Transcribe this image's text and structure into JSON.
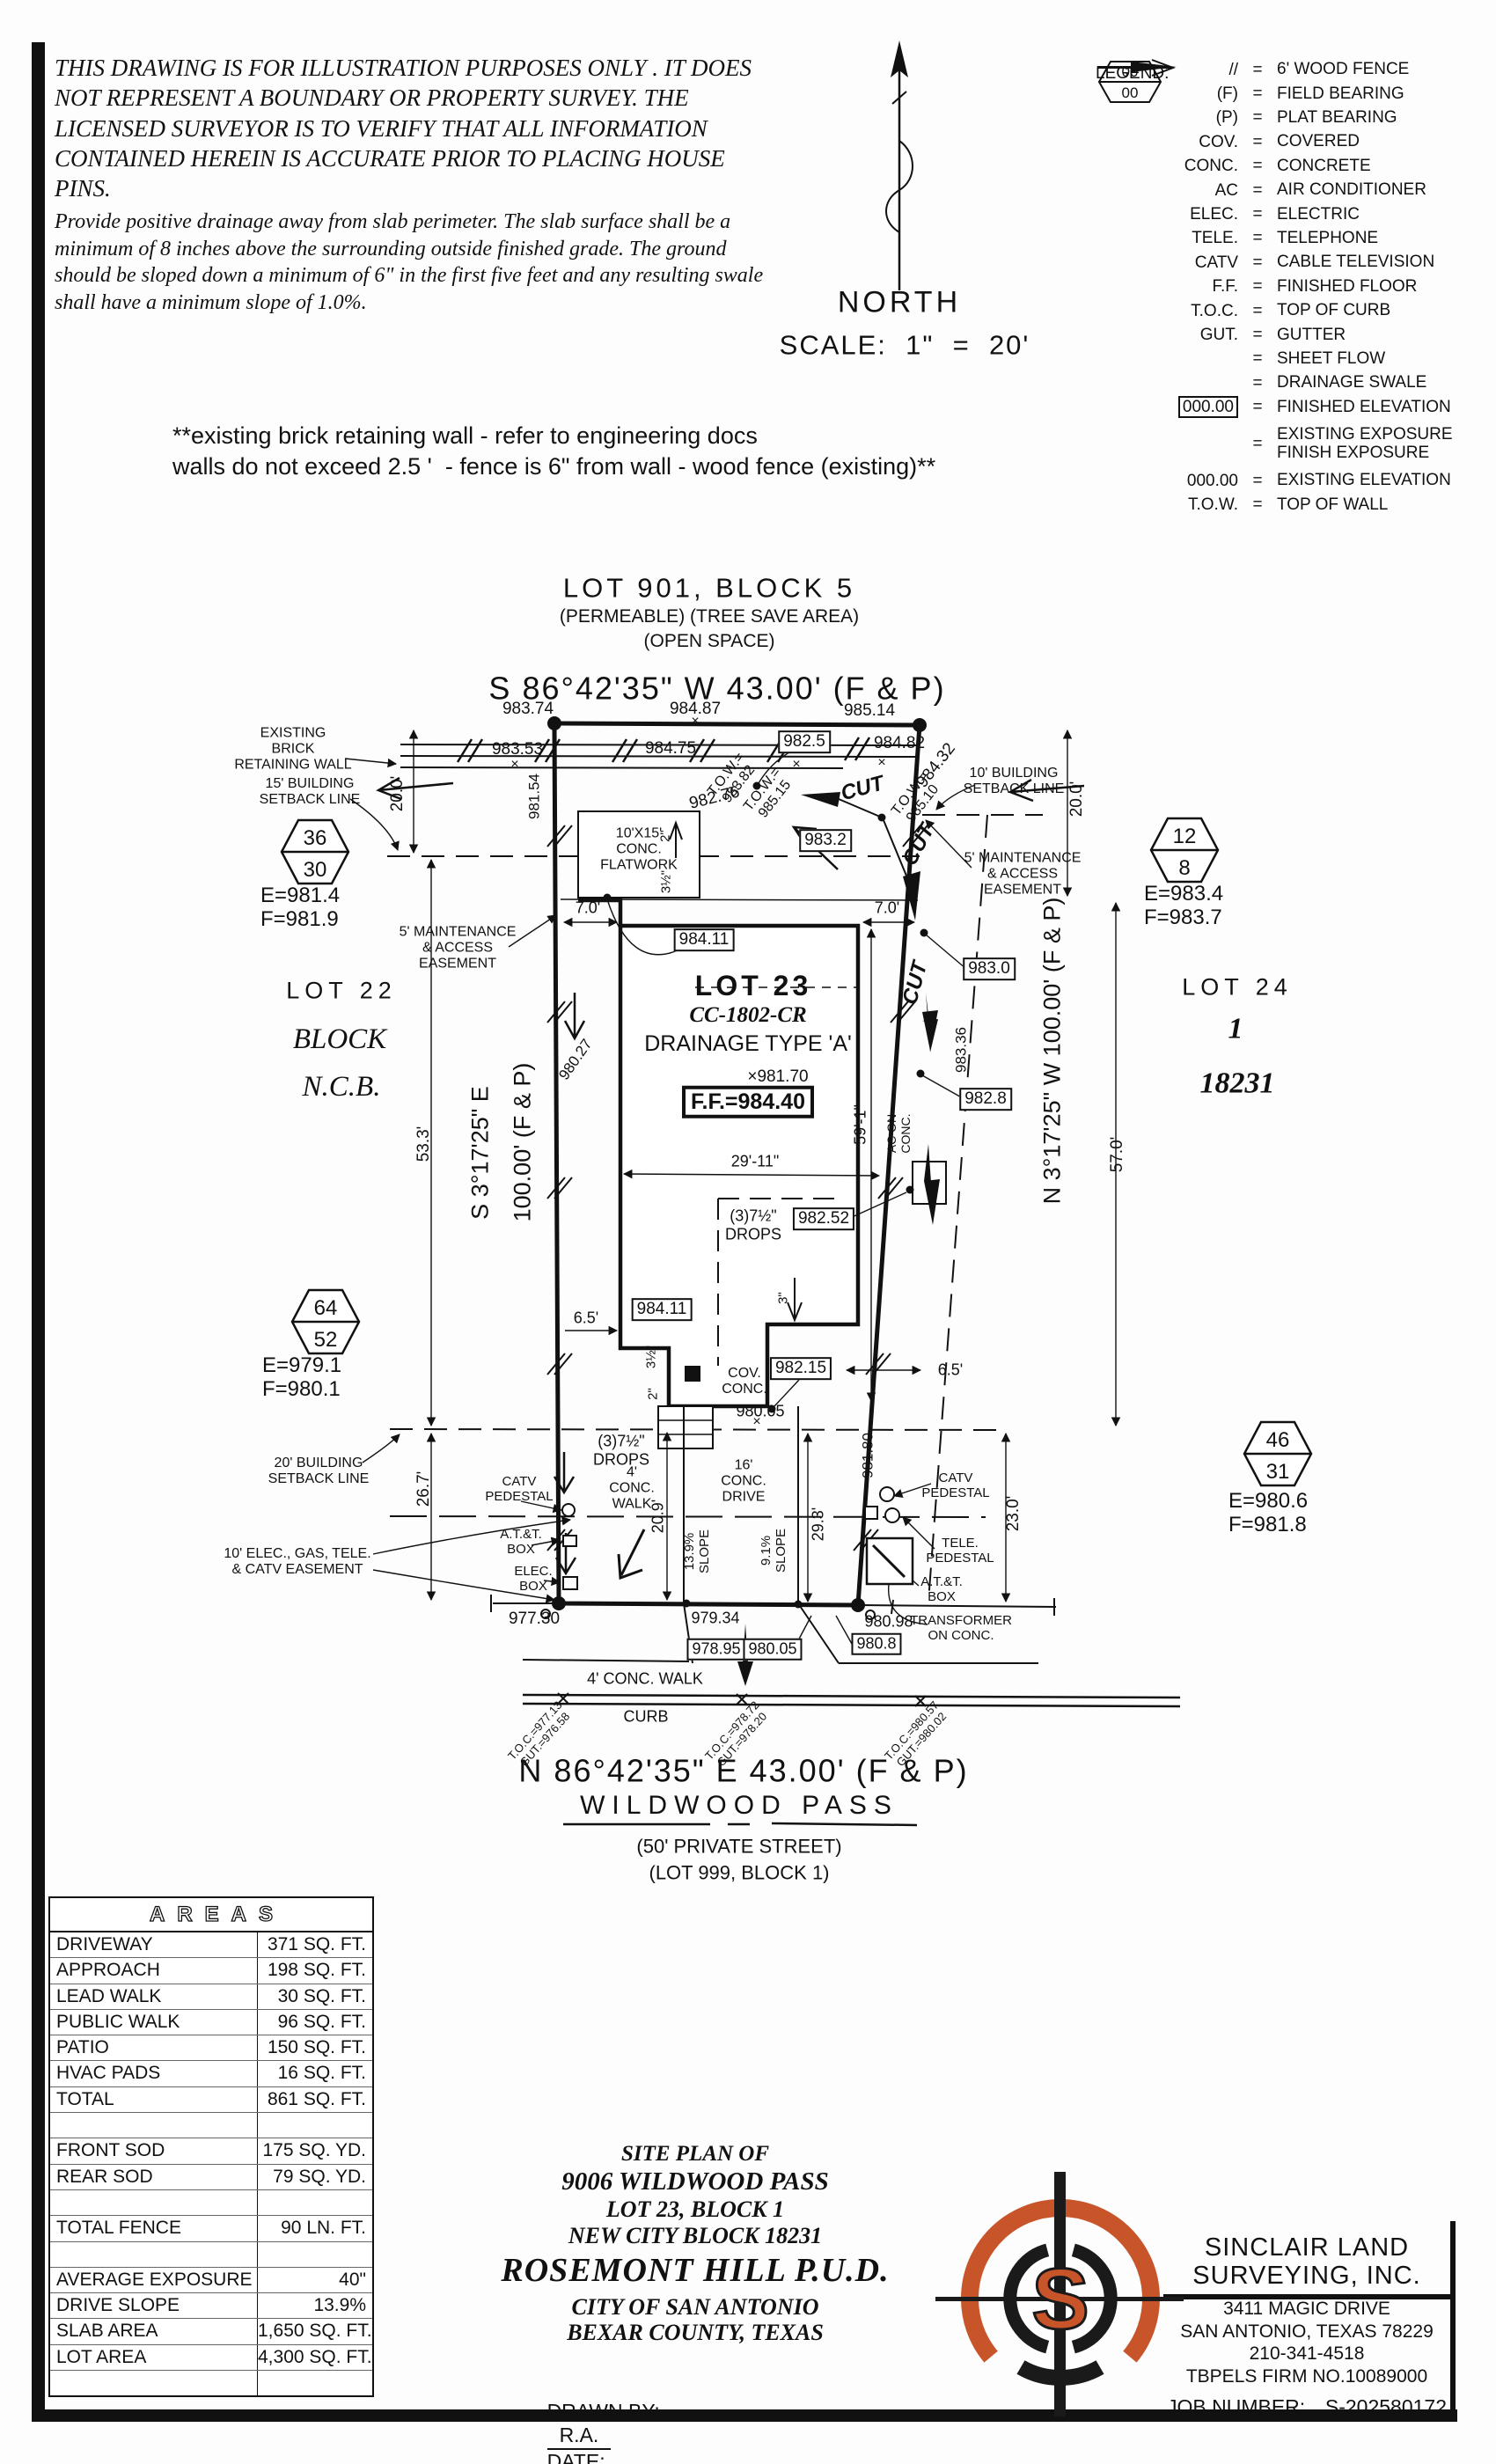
{
  "colors": {
    "ink": "#111111",
    "logo_orange": "#c8552a"
  },
  "page": {
    "disclaimer1": "THIS DRAWING IS FOR ILLUSTRATION PURPOSES ONLY . IT DOES NOT REPRESENT A BOUNDARY OR PROPERTY SURVEY. THE LICENSED SURVEYOR IS TO VERIFY THAT ALL INFORMATION CONTAINED HEREIN IS ACCURATE PRIOR TO PLACING HOUSE PINS.",
    "disclaimer2": "Provide positive drainage away from slab perimeter. The slab surface shall be a minimum of 8 inches above the surrounding outside finished grade. The ground should be sloped down a minimum of 6\" in the first five feet and any resulting swale shall have a minimum slope of 1.0%.",
    "north": "NORTH",
    "scale": "SCALE:  1\"  =  20'",
    "wall_note": "**existing brick retaining wall - refer to engineering docs\nwalls do not exceed 2.5 '  - fence is 6\" from wall - wood fence (existing)**"
  },
  "legend": {
    "title": "LEGEND:",
    "rows_a": [
      {
        "sym": "//",
        "desc": "6' WOOD FENCE"
      },
      {
        "sym": "(F)",
        "desc": "FIELD BEARING"
      },
      {
        "sym": "(P)",
        "desc": "PLAT BEARING"
      },
      {
        "sym": "COV.",
        "desc": "COVERED"
      },
      {
        "sym": "CONC.",
        "desc": "CONCRETE"
      },
      {
        "sym": "AC",
        "desc": "AIR CONDITIONER"
      },
      {
        "sym": "ELEC.",
        "desc": "ELECTRIC"
      },
      {
        "sym": "TELE.",
        "desc": "TELEPHONE"
      },
      {
        "sym": "CATV",
        "desc": "CABLE TELEVISION"
      },
      {
        "sym": "F.F.",
        "desc": "FINISHED FLOOR"
      },
      {
        "sym": "T.O.C.",
        "desc": "TOP OF CURB"
      },
      {
        "sym": "GUT.",
        "desc": "GUTTER"
      }
    ],
    "sheet_flow_desc": "SHEET FLOW",
    "swale_desc": "DRAINAGE SWALE",
    "finished_elev_sym": "000.00",
    "finished_elev_desc": "FINISHED ELEVATION",
    "hex_top": "00",
    "hex_bot": "00",
    "hex_desc": "EXISTING EXPOSURE\nFINISH EXPOSURE",
    "rows_b": [
      {
        "sym": "000.00",
        "desc": "EXISTING ELEVATION"
      },
      {
        "sym": "T.O.W.",
        "desc": "TOP OF WALL"
      }
    ]
  },
  "headings": {
    "lot901": "LOT 901, BLOCK 5",
    "permeable": "(PERMEABLE) (TREE SAVE AREA)",
    "openspace": "(OPEN SPACE)",
    "bearing_top": "S 86°42'35\" W 43.00' (F & P)",
    "bearing_bottom": "N 86°42'35\" E 43.00' (F & P)",
    "street": "WILDWOOD PASS",
    "street_sub1": "(50' PRIVATE STREET)",
    "street_sub2": "(LOT 999, BLOCK 1)"
  },
  "plan": {
    "labels": {
      "xmark": "×",
      "e98374": "983.74",
      "e98487": "984.87",
      "e98514": "985.14",
      "e98353": "983.53",
      "e98475": "984.75",
      "b9825": "982.5",
      "e98482": "984.82",
      "tow98382": "T.O.W.=\n983.82",
      "e98154": "981.54",
      "e98276": "982.76",
      "tow98515": "T.O.W.=\n985.15",
      "cut": "CUT",
      "tow98510": "T.O.W.=\n985.10",
      "e98432": "984.32",
      "b9832": "983.2",
      "existing_wall": "EXISTING\nBRICK\nRETAINING WALL",
      "bsl15": "15' BUILDING\nSETBACK LINE",
      "hex36": "36",
      "hex30": "30",
      "ef981": "E=981.4\nF=981.9",
      "lot22": "LOT 22",
      "block": "BLOCK",
      "ncb": "N.C.B.",
      "dim200L": "20.0'",
      "dim533": "53.3'",
      "dim267": "26.7'",
      "brgW1": "S 3°17'25\" E",
      "brgW2": "100.00' (F & P)",
      "e98027": "980.27",
      "maint5": "5' MAINTENANCE\n& ACCESS\nEASEMENT",
      "hex64": "64",
      "hex52": "52",
      "ef979": "E=979.1\nF=980.1",
      "bsl20": "20' BUILDING\nSETBACK LINE",
      "easement10": "10' ELEC., GAS, TELE.\n& CATV EASEMENT",
      "catv_ped": "CATV\nPEDESTAL",
      "att_box": "A.T.&T.\nBOX",
      "elec_box": "ELEC.\nBOX",
      "e97730": "977.30",
      "b98411": "984.11",
      "fw1015": "10'X15'\nCONC.\nFLATWORK",
      "d2": "2\"",
      "d312": "3½\"",
      "d3": "3\"",
      "dim70": "7.0'",
      "lot23": "LOT 23",
      "cc1802": "CC-1802-CR",
      "drainage": "DRAINAGE TYPE 'A'",
      "x98170": "×981.70",
      "ff": "F.F.=984.40",
      "dim591": "59'-1\"",
      "aconc": "AC ON\nCONC.",
      "b9830": "983.0",
      "e98336": "983.36",
      "b9828": "982.8",
      "dim2911": "29'-11\"",
      "drops": "(3)7½\"\nDROPS",
      "b98252": "982.52",
      "dim65": "6.5'",
      "covconc": "COV.\nCONC.",
      "b98215": "982.15",
      "e98005": "980.05",
      "dim200R": "20.0'",
      "bsl10": "10' BUILDING\nSETBACK LINE",
      "hex12": "12",
      "hex8": "8",
      "ef983": "E=983.4\nF=983.7",
      "lot24": "LOT 24",
      "one": "1",
      "n18231": "18231",
      "brgE": "N 3°17'25\" W 100.00' (F & P)",
      "dim570": "57.0'",
      "hex46": "46",
      "hex31": "31",
      "ef980": "E=980.6\nF=981.8",
      "dim230": "23.0'",
      "e98180": "981.80",
      "walk4": "4'\nCONC.\nWALK",
      "drive16": "16'\nCONC.\nDRIVE",
      "dim209": "20.9'",
      "slope139": "13.9%\nSLOPE",
      "slope91": "9.1%\nSLOPE",
      "dim293": "29.3'",
      "tele_ped": "TELE.\nPEDESTAL",
      "transformer": "TRANSFORMER\nON CONC.",
      "e98098": "980.98",
      "b9808": "980.8",
      "e97934": "979.34",
      "b97895": "978.95",
      "b98005": "980.05",
      "walk4b": "4' CONC. WALK",
      "curb": "CURB",
      "toc1": "T.O.C.=977.13\nGUT.=976.58",
      "toc2": "T.O.C.=978.72\nGUT.=978.20",
      "toc3": "T.O.C.=980.57\nGUT.=980.02"
    }
  },
  "areas": {
    "title": "AREAS",
    "rows": [
      {
        "label": "DRIVEWAY",
        "value": "371 SQ. FT."
      },
      {
        "label": "APPROACH",
        "value": "198 SQ. FT."
      },
      {
        "label": "LEAD WALK",
        "value": "30 SQ. FT."
      },
      {
        "label": "PUBLIC WALK",
        "value": "96 SQ. FT."
      },
      {
        "label": "PATIO",
        "value": "150 SQ. FT."
      },
      {
        "label": "HVAC PADS",
        "value": "16 SQ. FT."
      },
      {
        "label": "TOTAL",
        "value": "861 SQ. FT."
      },
      {
        "label": "",
        "value": ""
      },
      {
        "label": "FRONT SOD",
        "value": "175 SQ. YD."
      },
      {
        "label": "REAR SOD",
        "value": "79 SQ. YD."
      },
      {
        "label": "",
        "value": ""
      },
      {
        "label": "TOTAL FENCE",
        "value": "90 LN. FT."
      },
      {
        "label": "",
        "value": ""
      },
      {
        "label": "AVERAGE EXPOSURE",
        "value": "40\""
      },
      {
        "label": "DRIVE SLOPE",
        "value": "13.9%"
      },
      {
        "label": "SLAB AREA",
        "value": "1,650 SQ. FT."
      },
      {
        "label": "LOT AREA",
        "value": "4,300 SQ. FT."
      },
      {
        "label": "",
        "value": ""
      }
    ]
  },
  "titleblock": {
    "l1": "SITE PLAN OF",
    "l2": "9006 WILDWOOD PASS",
    "l3": "LOT 23, BLOCK 1",
    "l4": "NEW CITY BLOCK 18231",
    "l5": "ROSEMONT HILL P.U.D.",
    "l6": "CITY OF SAN ANTONIO",
    "l7": "BEXAR COUNTY, TEXAS",
    "drawn_by_label": "DRAWN BY:",
    "drawn_by": "R.A.",
    "date_label": "DATE:",
    "date": "3/12/2025"
  },
  "surveyor": {
    "logo_letter": "S",
    "name1": "SINCLAIR LAND",
    "name2": "SURVEYING, INC.",
    "addr1": "3411 MAGIC DRIVE",
    "addr2": "SAN ANTONIO, TEXAS 78229",
    "phone": "210-341-4518",
    "firm": "TBPELS FIRM NO.10089000",
    "job_label": "JOB NUMBER:",
    "job_value": "S-202580172"
  }
}
